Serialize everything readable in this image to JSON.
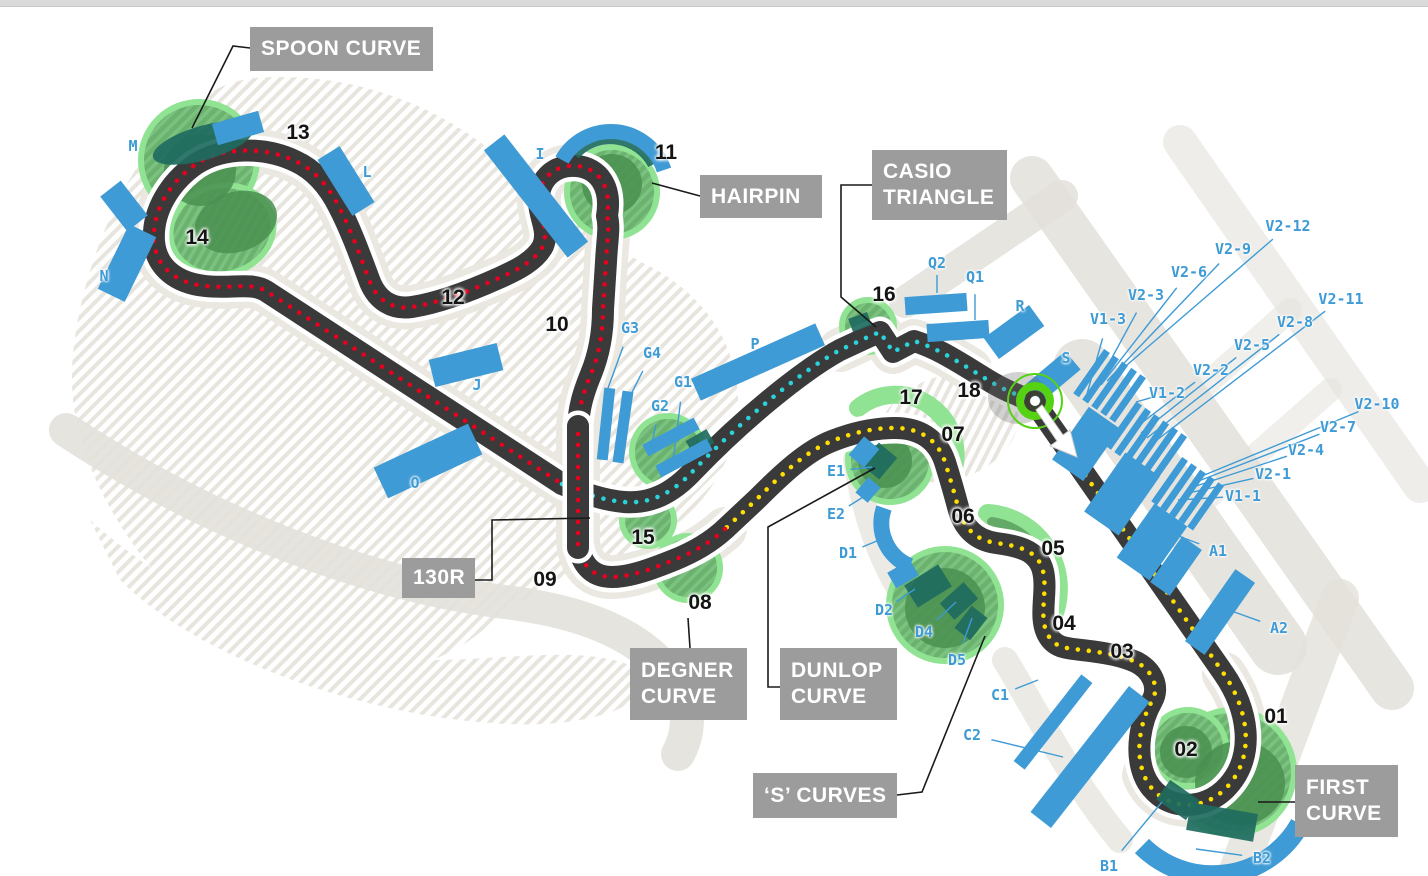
{
  "map": {
    "colors": {
      "blue": "#3e9bd5",
      "track": "#3a3a3a",
      "dot_yellow": "#ffdf00",
      "dot_red": "#e8001e",
      "dot_cyan": "#2ad2da",
      "green_light": "#90e392",
      "green_mid": "#6ab26e",
      "green_dark": "#4a8f50",
      "teal": "#1f6b5f",
      "box_gray": "#9c9c9c",
      "road": "#e3e1da",
      "lime": "#55d212",
      "label_dark": "#141414"
    },
    "callouts": [
      {
        "id": "spoon-curve",
        "lines": [
          "SPOON CURVE"
        ],
        "x": 250,
        "y": 27,
        "w": 183,
        "h": 44,
        "connector": [
          [
            250,
            48
          ],
          [
            233,
            46
          ],
          [
            192,
            128
          ]
        ]
      },
      {
        "id": "hairpin",
        "lines": [
          "HAIRPIN"
        ],
        "x": 700,
        "y": 175,
        "w": 122,
        "h": 43,
        "connector": [
          [
            700,
            196
          ],
          [
            652,
            183
          ]
        ]
      },
      {
        "id": "casio-triangle",
        "lines": [
          "CASIO",
          "TRIANGLE"
        ],
        "x": 872,
        "y": 150,
        "w": 135,
        "h": 70,
        "connector": [
          [
            872,
            185
          ],
          [
            841,
            185
          ],
          [
            841,
            297
          ],
          [
            876,
            327
          ]
        ]
      },
      {
        "id": "130r",
        "lines": [
          "130R"
        ],
        "x": 402,
        "y": 558,
        "w": 73,
        "h": 40,
        "connector": [
          [
            475,
            580
          ],
          [
            492,
            580
          ],
          [
            492,
            520
          ],
          [
            590,
            518
          ]
        ]
      },
      {
        "id": "degner-curve",
        "lines": [
          "DEGNER",
          "CURVE"
        ],
        "x": 630,
        "y": 648,
        "w": 117,
        "h": 72,
        "connector": [
          [
            690,
            648
          ],
          [
            688,
            618
          ]
        ]
      },
      {
        "id": "dunlop-curve",
        "lines": [
          "DUNLOP",
          "CURVE"
        ],
        "x": 780,
        "y": 648,
        "w": 117,
        "h": 72,
        "connector": [
          [
            780,
            687
          ],
          [
            768,
            687
          ],
          [
            768,
            527
          ],
          [
            875,
            468
          ]
        ]
      },
      {
        "id": "s-curves",
        "lines": [
          "‘S’ CURVES"
        ],
        "x": 753,
        "y": 773,
        "w": 144,
        "h": 45,
        "connector": [
          [
            897,
            795
          ],
          [
            922,
            792
          ],
          [
            985,
            636
          ]
        ]
      },
      {
        "id": "first-curve",
        "lines": [
          "FIRST",
          "CURVE"
        ],
        "x": 1295,
        "y": 765,
        "w": 103,
        "h": 72,
        "connector": [
          [
            1295,
            802
          ],
          [
            1258,
            802
          ]
        ]
      }
    ],
    "corners": [
      {
        "label": "01",
        "x": 1276,
        "y": 717
      },
      {
        "label": "02",
        "x": 1186,
        "y": 750
      },
      {
        "label": "03",
        "x": 1122,
        "y": 652
      },
      {
        "label": "04",
        "x": 1064,
        "y": 624
      },
      {
        "label": "05",
        "x": 1053,
        "y": 549
      },
      {
        "label": "06",
        "x": 963,
        "y": 517
      },
      {
        "label": "07",
        "x": 953,
        "y": 435
      },
      {
        "label": "08",
        "x": 700,
        "y": 603
      },
      {
        "label": "09",
        "x": 545,
        "y": 580
      },
      {
        "label": "10",
        "x": 557,
        "y": 325
      },
      {
        "label": "11",
        "x": 666,
        "y": 153
      },
      {
        "label": "12",
        "x": 453,
        "y": 298
      },
      {
        "label": "13",
        "x": 298,
        "y": 133
      },
      {
        "label": "14",
        "x": 197,
        "y": 238
      },
      {
        "label": "15",
        "x": 643,
        "y": 538
      },
      {
        "label": "16",
        "x": 884,
        "y": 295
      },
      {
        "label": "17",
        "x": 911,
        "y": 398
      },
      {
        "label": "18",
        "x": 969,
        "y": 391
      }
    ],
    "stand_labels": [
      {
        "label": "M",
        "x": 133,
        "y": 146
      },
      {
        "label": "N",
        "x": 104,
        "y": 276
      },
      {
        "label": "L",
        "x": 367,
        "y": 172
      },
      {
        "label": "I",
        "x": 540,
        "y": 154
      },
      {
        "label": "J",
        "x": 477,
        "y": 385
      },
      {
        "label": "O",
        "x": 415,
        "y": 483
      },
      {
        "label": "P",
        "x": 755,
        "y": 344
      },
      {
        "label": "R",
        "x": 1020,
        "y": 306
      },
      {
        "label": "S",
        "x": 1066,
        "y": 358
      }
    ],
    "leader_labels": [
      {
        "label": "Q2",
        "x": 937,
        "y": 263,
        "tx": 937,
        "ty": 293
      },
      {
        "label": "Q1",
        "x": 975,
        "y": 277,
        "tx": 975,
        "ty": 320
      },
      {
        "label": "G3",
        "x": 630,
        "y": 328,
        "tx": 608,
        "ty": 388
      },
      {
        "label": "G4",
        "x": 652,
        "y": 353,
        "tx": 623,
        "ty": 410
      },
      {
        "label": "G1",
        "x": 683,
        "y": 382,
        "tx": 673,
        "ty": 462
      },
      {
        "label": "G2",
        "x": 660,
        "y": 406,
        "tx": 650,
        "ty": 452
      },
      {
        "label": "E1",
        "x": 836,
        "y": 471,
        "tx": 872,
        "ty": 467
      },
      {
        "label": "E2",
        "x": 836,
        "y": 514,
        "tx": 868,
        "ty": 494
      },
      {
        "label": "D1",
        "x": 848,
        "y": 553,
        "tx": 884,
        "ty": 538
      },
      {
        "label": "D2",
        "x": 884,
        "y": 610,
        "tx": 915,
        "ty": 589
      },
      {
        "label": "D4",
        "x": 924,
        "y": 632,
        "tx": 956,
        "ty": 602
      },
      {
        "label": "D5",
        "x": 957,
        "y": 660,
        "tx": 972,
        "ty": 618
      },
      {
        "label": "C1",
        "x": 1000,
        "y": 695,
        "tx": 1038,
        "ty": 680
      },
      {
        "label": "C2",
        "x": 972,
        "y": 735,
        "tx": 1063,
        "ty": 757
      },
      {
        "label": "B1",
        "x": 1109,
        "y": 866,
        "tx": 1162,
        "ty": 802
      },
      {
        "label": "B2",
        "x": 1262,
        "y": 858,
        "tx": 1196,
        "ty": 849
      },
      {
        "label": "A1",
        "x": 1218,
        "y": 551,
        "tx": 1168,
        "ty": 532
      },
      {
        "label": "A2",
        "x": 1279,
        "y": 628,
        "tx": 1226,
        "ty": 609
      },
      {
        "label": "V1-1",
        "x": 1243,
        "y": 496,
        "tx": 1178,
        "ty": 500
      },
      {
        "label": "V2-1",
        "x": 1273,
        "y": 474,
        "tx": 1184,
        "ty": 494
      },
      {
        "label": "V2-4",
        "x": 1306,
        "y": 450,
        "tx": 1190,
        "ty": 488
      },
      {
        "label": "V2-7",
        "x": 1338,
        "y": 427,
        "tx": 1196,
        "ty": 482
      },
      {
        "label": "V2-10",
        "x": 1377,
        "y": 404,
        "tx": 1202,
        "ty": 476
      },
      {
        "label": "V1-2",
        "x": 1167,
        "y": 393,
        "tx": 1136,
        "ty": 402
      },
      {
        "label": "V2-2",
        "x": 1211,
        "y": 370,
        "tx": 1135,
        "ty": 428
      },
      {
        "label": "V2-5",
        "x": 1252,
        "y": 345,
        "tx": 1141,
        "ty": 433
      },
      {
        "label": "V2-8",
        "x": 1295,
        "y": 322,
        "tx": 1147,
        "ty": 438
      },
      {
        "label": "V2-11",
        "x": 1341,
        "y": 299,
        "tx": 1153,
        "ty": 443
      },
      {
        "label": "V1-3",
        "x": 1108,
        "y": 319,
        "tx": 1087,
        "ty": 394
      },
      {
        "label": "V2-3",
        "x": 1146,
        "y": 295,
        "tx": 1095,
        "ty": 389
      },
      {
        "label": "V2-6",
        "x": 1189,
        "y": 272,
        "tx": 1101,
        "ty": 385
      },
      {
        "label": "V2-9",
        "x": 1233,
        "y": 249,
        "tx": 1107,
        "ty": 381
      },
      {
        "label": "V2-12",
        "x": 1288,
        "y": 226,
        "tx": 1113,
        "ty": 377
      }
    ]
  }
}
